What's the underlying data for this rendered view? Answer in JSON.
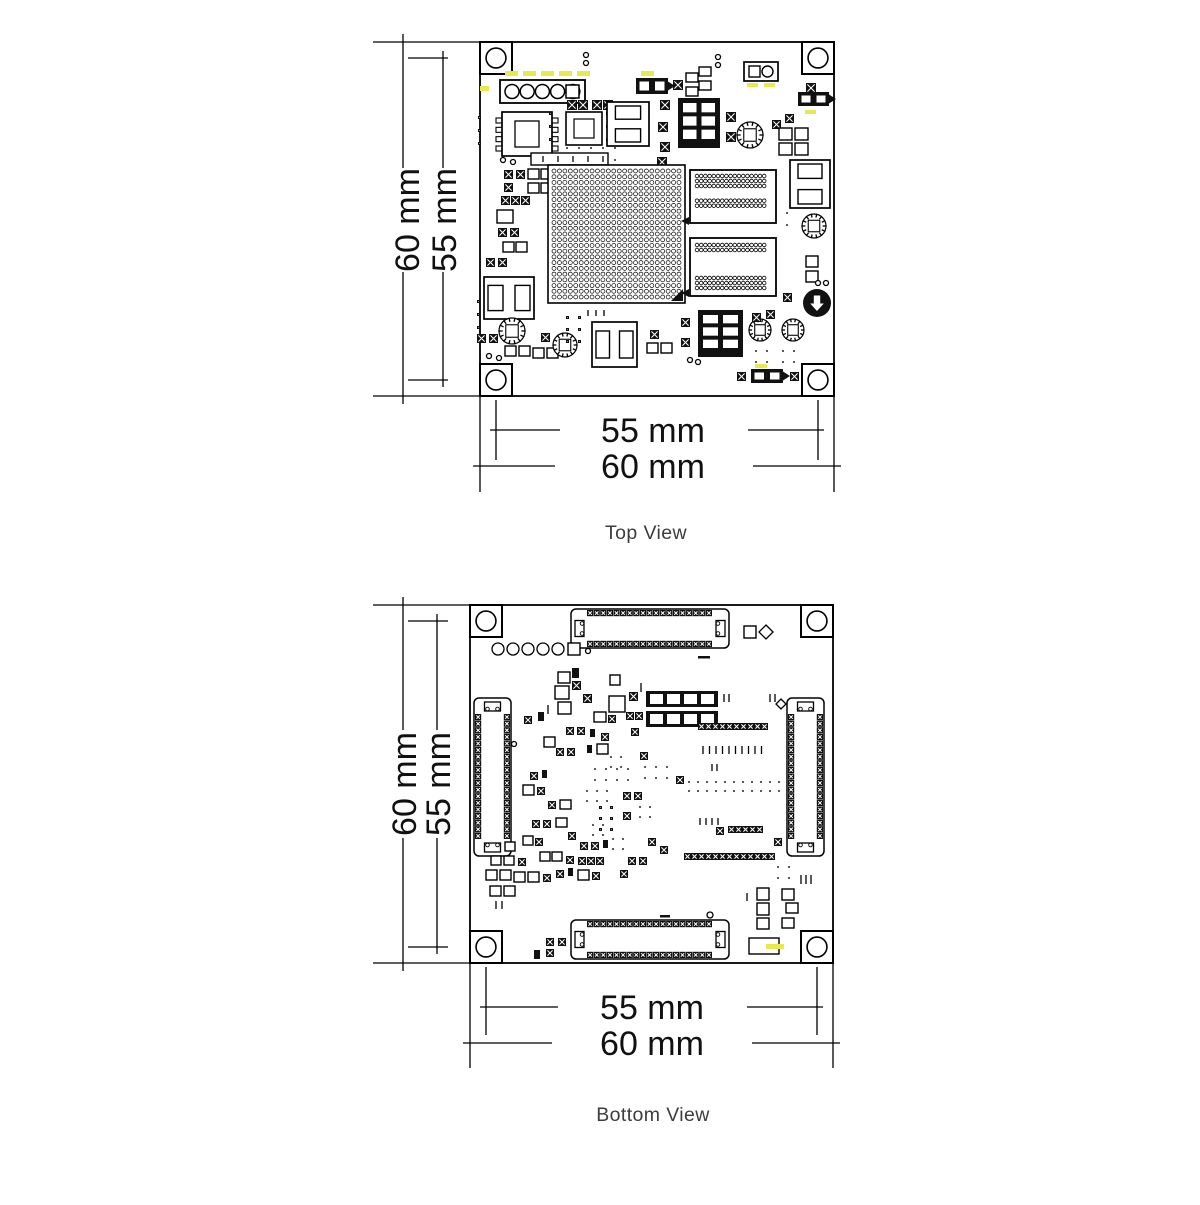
{
  "title": "PCB dimension drawing",
  "colors": {
    "line": "#000000",
    "caption": "#3c3c3c",
    "highlight": "#e8e84f",
    "dark_fill": "#111111"
  },
  "top_view": {
    "caption": "Top View",
    "dim_height_outer": "60 mm",
    "dim_height_inner": "55 mm",
    "dim_width_inner": "55 mm",
    "dim_width_outer": "60 mm",
    "components": [
      [
        "hole",
        480,
        42,
        32
      ],
      [
        "hole",
        802,
        42,
        32
      ],
      [
        "hole",
        480,
        364,
        32
      ],
      [
        "hole",
        802,
        364,
        32
      ],
      [
        "c",
        586,
        55,
        2.5
      ],
      [
        "c",
        586,
        63,
        2.5
      ],
      [
        "c",
        718,
        57,
        2.5
      ],
      [
        "c",
        718,
        65,
        2.5
      ],
      [
        "header5",
        500,
        80,
        85,
        23
      ],
      [
        "y",
        505,
        71,
        13,
        5
      ],
      [
        "y",
        523,
        71,
        13,
        5
      ],
      [
        "y",
        541,
        71,
        13,
        5
      ],
      [
        "y",
        559,
        71,
        13,
        5
      ],
      [
        "y",
        577,
        71,
        13,
        5
      ],
      [
        "y",
        480,
        86,
        9,
        5
      ],
      [
        "y",
        641,
        71,
        13,
        5
      ],
      [
        "jump",
        636,
        78,
        32,
        16
      ],
      [
        "x",
        673,
        80,
        10
      ],
      [
        "r",
        686,
        73,
        12,
        9
      ],
      [
        "r",
        699,
        67,
        12,
        9
      ],
      [
        "r",
        686,
        87,
        12,
        9
      ],
      [
        "r",
        699,
        81,
        12,
        9
      ],
      [
        "sqcirc",
        744,
        62,
        34,
        19
      ],
      [
        "y",
        747,
        83,
        11,
        4
      ],
      [
        "y",
        764,
        83,
        11,
        4
      ],
      [
        "x",
        806,
        83,
        10
      ],
      [
        "jump",
        798,
        92,
        31,
        14
      ],
      [
        "y",
        805,
        110,
        11,
        4
      ],
      [
        "xgrid",
        478,
        116,
        1,
        3,
        10,
        1
      ],
      [
        "soic",
        502,
        112,
        50,
        44
      ],
      [
        "c",
        503,
        160,
        2.5
      ],
      [
        "c",
        513,
        162,
        2.5
      ],
      [
        "xgrid",
        549,
        112,
        1,
        3,
        10,
        1
      ],
      [
        "xrow",
        567,
        100,
        2,
        10,
        1
      ],
      [
        "xrow",
        592,
        100,
        2,
        10,
        1
      ],
      [
        "qfn",
        566,
        112,
        36,
        33
      ],
      [
        "xgrid",
        606,
        112,
        1,
        3,
        10,
        1
      ],
      [
        "xgrid",
        566,
        147,
        5,
        2,
        10,
        2
      ],
      [
        "r",
        531,
        153,
        77,
        12
      ],
      [
        "ticks",
        543,
        156,
        5,
        15,
        6
      ],
      [
        "pads2v",
        607,
        102,
        42,
        44
      ],
      [
        "pads6",
        678,
        98,
        42,
        50
      ],
      [
        "x",
        660,
        100,
        10
      ],
      [
        "x",
        658,
        122,
        10
      ],
      [
        "x",
        660,
        142,
        10
      ],
      [
        "x",
        657,
        157,
        10
      ],
      [
        "x",
        726,
        112,
        10
      ],
      [
        "x",
        726,
        132,
        10
      ],
      [
        "ind",
        750,
        135,
        13
      ],
      [
        "x",
        772,
        120,
        9
      ],
      [
        "x",
        785,
        114,
        9
      ],
      [
        "r",
        779,
        128,
        13,
        12
      ],
      [
        "r",
        795,
        128,
        13,
        12
      ],
      [
        "r",
        779,
        143,
        13,
        12
      ],
      [
        "r",
        795,
        143,
        13,
        12
      ],
      [
        "pads2v",
        790,
        160,
        40,
        48
      ],
      [
        "xgrid",
        786,
        212,
        1,
        2,
        10,
        2
      ],
      [
        "ind",
        814,
        226,
        12
      ],
      [
        "xgrid",
        755,
        250,
        2,
        4,
        9,
        1
      ],
      [
        "r",
        806,
        256,
        12,
        11
      ],
      [
        "r",
        806,
        271,
        12,
        11
      ],
      [
        "c",
        818,
        283,
        2.5
      ],
      [
        "c",
        826,
        283,
        2.5
      ],
      [
        "x",
        783,
        293,
        9
      ],
      [
        "badge",
        817,
        303,
        14
      ],
      [
        "x",
        504,
        170,
        9
      ],
      [
        "x",
        516,
        170,
        9
      ],
      [
        "r",
        528,
        169,
        11,
        10
      ],
      [
        "r",
        541,
        169,
        11,
        10
      ],
      [
        "x",
        504,
        183,
        9
      ],
      [
        "r",
        528,
        183,
        11,
        10
      ],
      [
        "r",
        541,
        183,
        11,
        10
      ],
      [
        "xrow",
        501,
        196,
        3,
        9,
        1
      ],
      [
        "r",
        497,
        210,
        16,
        13
      ],
      [
        "x",
        498,
        228,
        9
      ],
      [
        "x",
        510,
        228,
        9
      ],
      [
        "r",
        503,
        242,
        11,
        10
      ],
      [
        "r",
        516,
        242,
        11,
        10
      ],
      [
        "x",
        486,
        258,
        9
      ],
      [
        "x",
        498,
        258,
        9
      ],
      [
        "bga",
        548,
        165,
        137,
        138
      ],
      [
        "dotconn",
        690,
        170,
        86,
        53,
        0
      ],
      [
        "dotconn",
        690,
        238,
        86,
        58,
        1
      ],
      [
        "tri",
        689,
        221
      ],
      [
        "tri",
        689,
        293
      ],
      [
        "pads2h",
        484,
        277,
        50,
        42
      ],
      [
        "xgrid",
        477,
        300,
        1,
        3,
        10,
        1
      ],
      [
        "x",
        477,
        334,
        9
      ],
      [
        "x",
        489,
        334,
        9
      ],
      [
        "ind",
        512,
        331,
        13
      ],
      [
        "r",
        505,
        346,
        11,
        10
      ],
      [
        "r",
        519,
        346,
        11,
        10
      ],
      [
        "r",
        533,
        348,
        11,
        10
      ],
      [
        "r",
        547,
        348,
        11,
        10
      ],
      [
        "x",
        541,
        333,
        9
      ],
      [
        "ind",
        565,
        345,
        12
      ],
      [
        "xgrid",
        566,
        316,
        2,
        3,
        9,
        1
      ],
      [
        "ticks",
        588,
        310,
        3,
        8,
        6
      ],
      [
        "pads2h",
        592,
        322,
        45,
        45
      ],
      [
        "x",
        650,
        330,
        9
      ],
      [
        "r",
        647,
        343,
        11,
        10
      ],
      [
        "r",
        661,
        343,
        11,
        10
      ],
      [
        "x",
        681,
        318,
        9
      ],
      [
        "x",
        681,
        338,
        9
      ],
      [
        "pads6",
        698,
        310,
        45,
        47
      ],
      [
        "c",
        690,
        360,
        2.5
      ],
      [
        "c",
        698,
        362,
        2.5
      ],
      [
        "ind",
        760,
        330,
        11
      ],
      [
        "ind",
        793,
        330,
        11
      ],
      [
        "x",
        752,
        313,
        9
      ],
      [
        "x",
        766,
        310,
        9
      ],
      [
        "xgrid",
        755,
        350,
        2,
        2,
        9,
        1
      ],
      [
        "xgrid",
        782,
        350,
        2,
        2,
        9,
        1
      ],
      [
        "x",
        737,
        372,
        9
      ],
      [
        "jump",
        751,
        369,
        32,
        14
      ],
      [
        "x",
        790,
        372,
        9
      ],
      [
        "y",
        755,
        364,
        12,
        4
      ],
      [
        "c",
        489,
        356,
        2.5
      ],
      [
        "c",
        499,
        358,
        2.5
      ]
    ]
  },
  "bottom_view": {
    "caption": "Bottom View",
    "dim_height_outer": "60 mm",
    "dim_height_inner": "55 mm",
    "dim_width_inner": "55 mm",
    "dim_width_outer": "60 mm",
    "components": [
      [
        "hole",
        470,
        605,
        32
      ],
      [
        "hole",
        801,
        605,
        32
      ],
      [
        "hole",
        470,
        931,
        32
      ],
      [
        "hole",
        801,
        931,
        32
      ],
      [
        "beadh",
        571,
        609,
        158,
        39
      ],
      [
        "beadh",
        571,
        920,
        158,
        39
      ],
      [
        "beadv",
        474,
        698,
        37,
        158
      ],
      [
        "beadv",
        787,
        698,
        37,
        158
      ],
      [
        "c",
        498,
        649,
        6
      ],
      [
        "c",
        513,
        649,
        6
      ],
      [
        "c",
        528,
        649,
        6
      ],
      [
        "c",
        543,
        649,
        6
      ],
      [
        "c",
        558,
        649,
        6
      ],
      [
        "r",
        568,
        643,
        12,
        12
      ],
      [
        "c",
        588,
        651,
        2.5
      ],
      [
        "r",
        744,
        626,
        12,
        12
      ],
      [
        "diam",
        766,
        632,
        7
      ],
      [
        "f",
        698,
        656,
        12,
        2.5
      ],
      [
        "f",
        660,
        915,
        10,
        2.5
      ],
      [
        "r",
        558,
        672,
        12,
        11
      ],
      [
        "r",
        555,
        686,
        14,
        13
      ],
      [
        "x",
        572,
        681,
        9
      ],
      [
        "r",
        558,
        702,
        13,
        12
      ],
      [
        "f",
        572,
        668,
        7,
        10
      ],
      [
        "x",
        583,
        694,
        9
      ],
      [
        "ticks",
        548,
        705,
        1,
        5,
        9
      ],
      [
        "r",
        610,
        675,
        10,
        10
      ],
      [
        "r",
        609,
        696,
        16,
        16
      ],
      [
        "x",
        629,
        692,
        9
      ],
      [
        "ticks",
        641,
        683,
        1,
        5,
        9
      ],
      [
        "blkpads",
        646,
        691,
        72,
        16,
        4
      ],
      [
        "blkpads",
        646,
        711,
        72,
        16,
        4
      ],
      [
        "ticks",
        724,
        694,
        2,
        5,
        8
      ],
      [
        "xrow",
        626,
        712,
        2,
        8,
        1
      ],
      [
        "xrow",
        698,
        723,
        10,
        7
      ],
      [
        "ticks",
        703,
        746,
        10,
        6.5,
        8
      ],
      [
        "ticks",
        770,
        694,
        2,
        5,
        8
      ],
      [
        "x",
        524,
        716,
        8
      ],
      [
        "f",
        538,
        712,
        6,
        9
      ],
      [
        "r",
        594,
        712,
        12,
        10
      ],
      [
        "x",
        608,
        715,
        8
      ],
      [
        "x",
        566,
        727,
        8
      ],
      [
        "x",
        577,
        727,
        8
      ],
      [
        "r",
        544,
        737,
        11,
        10
      ],
      [
        "x",
        601,
        733,
        8
      ],
      [
        "x",
        631,
        728,
        8
      ],
      [
        "f",
        590,
        729,
        5,
        8
      ],
      [
        "x",
        556,
        748,
        8
      ],
      [
        "x",
        567,
        748,
        8
      ],
      [
        "r",
        597,
        744,
        11,
        10
      ],
      [
        "f",
        587,
        745,
        5,
        8
      ],
      [
        "xgrid",
        610,
        756,
        2,
        2,
        8,
        1
      ],
      [
        "x",
        640,
        752,
        8
      ],
      [
        "c",
        514,
        744,
        2.5
      ],
      [
        "xgrid",
        594,
        768,
        4,
        2,
        9,
        1
      ],
      [
        "xgrid",
        644,
        766,
        3,
        2,
        9,
        1
      ],
      [
        "x",
        676,
        776,
        8
      ],
      [
        "x",
        530,
        772,
        8
      ],
      [
        "f",
        542,
        770,
        5,
        8
      ],
      [
        "r",
        523,
        785,
        11,
        10
      ],
      [
        "x",
        537,
        787,
        8
      ],
      [
        "xgrid",
        586,
        790,
        3,
        2,
        8,
        1
      ],
      [
        "x",
        623,
        792,
        8
      ],
      [
        "x",
        634,
        792,
        8
      ],
      [
        "x",
        548,
        801,
        8
      ],
      [
        "r",
        560,
        800,
        11,
        9
      ],
      [
        "xgrid",
        599,
        806,
        2,
        3,
        8,
        1
      ],
      [
        "x",
        623,
        812,
        8
      ],
      [
        "xgrid",
        639,
        806,
        2,
        2,
        8,
        1
      ],
      [
        "xgrid",
        688,
        781,
        11,
        2,
        7,
        0
      ],
      [
        "ticks",
        712,
        764,
        2,
        5,
        7
      ],
      [
        "x",
        532,
        820,
        8
      ],
      [
        "x",
        543,
        820,
        8
      ],
      [
        "r",
        556,
        818,
        11,
        9
      ],
      [
        "xgrid",
        592,
        824,
        2,
        2,
        8,
        1
      ],
      [
        "x",
        568,
        832,
        8
      ],
      [
        "r",
        523,
        836,
        10,
        9
      ],
      [
        "x",
        535,
        838,
        8
      ],
      [
        "x",
        580,
        842,
        8
      ],
      [
        "x",
        591,
        842,
        8
      ],
      [
        "f",
        603,
        840,
        5,
        8
      ],
      [
        "xgrid",
        612,
        838,
        2,
        2,
        8,
        1
      ],
      [
        "x",
        648,
        838,
        8
      ],
      [
        "xrow",
        728,
        826,
        5,
        7
      ],
      [
        "x",
        716,
        827,
        8
      ],
      [
        "ticks",
        700,
        818,
        4,
        6,
        7
      ],
      [
        "x",
        774,
        838,
        8
      ],
      [
        "x",
        660,
        846,
        8
      ],
      [
        "xrow",
        684,
        853,
        13,
        7
      ],
      [
        "r",
        540,
        852,
        10,
        9
      ],
      [
        "r",
        552,
        852,
        10,
        9
      ],
      [
        "x",
        566,
        856,
        8
      ],
      [
        "xrow",
        578,
        857,
        3,
        8,
        1
      ],
      [
        "x",
        628,
        857,
        8
      ],
      [
        "x",
        639,
        857,
        8
      ],
      [
        "r",
        505,
        842,
        10,
        9
      ],
      [
        "r",
        491,
        856,
        10,
        9
      ],
      [
        "r",
        504,
        856,
        10,
        9
      ],
      [
        "x",
        518,
        858,
        8
      ],
      [
        "r",
        486,
        870,
        11,
        10
      ],
      [
        "r",
        500,
        870,
        11,
        10
      ],
      [
        "r",
        514,
        872,
        11,
        10
      ],
      [
        "r",
        528,
        872,
        11,
        10
      ],
      [
        "x",
        543,
        874,
        8
      ],
      [
        "r",
        490,
        886,
        11,
        10
      ],
      [
        "r",
        504,
        886,
        11,
        10
      ],
      [
        "ticks",
        496,
        901,
        2,
        6,
        8
      ],
      [
        "x",
        556,
        870,
        8
      ],
      [
        "f",
        568,
        868,
        5,
        8
      ],
      [
        "r",
        578,
        870,
        11,
        10
      ],
      [
        "x",
        592,
        872,
        8
      ],
      [
        "x",
        620,
        870,
        8
      ],
      [
        "x",
        546,
        938,
        8
      ],
      [
        "x",
        558,
        938,
        8
      ],
      [
        "x",
        546,
        949,
        8
      ],
      [
        "f",
        534,
        950,
        6,
        9
      ],
      [
        "c",
        710,
        915,
        3
      ],
      [
        "xgrid",
        777,
        866,
        2,
        2,
        9,
        1
      ],
      [
        "ticks",
        801,
        875,
        3,
        5,
        9
      ],
      [
        "r",
        757,
        888,
        12,
        12
      ],
      [
        "r",
        757,
        903,
        12,
        12
      ],
      [
        "r",
        757,
        918,
        12,
        11
      ],
      [
        "r",
        782,
        889,
        12,
        11
      ],
      [
        "r",
        786,
        903,
        12,
        10
      ],
      [
        "r",
        782,
        918,
        12,
        10
      ],
      [
        "ticks",
        747,
        893,
        1,
        5,
        8
      ],
      [
        "diam",
        781,
        704,
        5
      ],
      [
        "r",
        749,
        938,
        30,
        16
      ],
      [
        "y",
        766,
        944,
        18,
        5
      ]
    ]
  }
}
